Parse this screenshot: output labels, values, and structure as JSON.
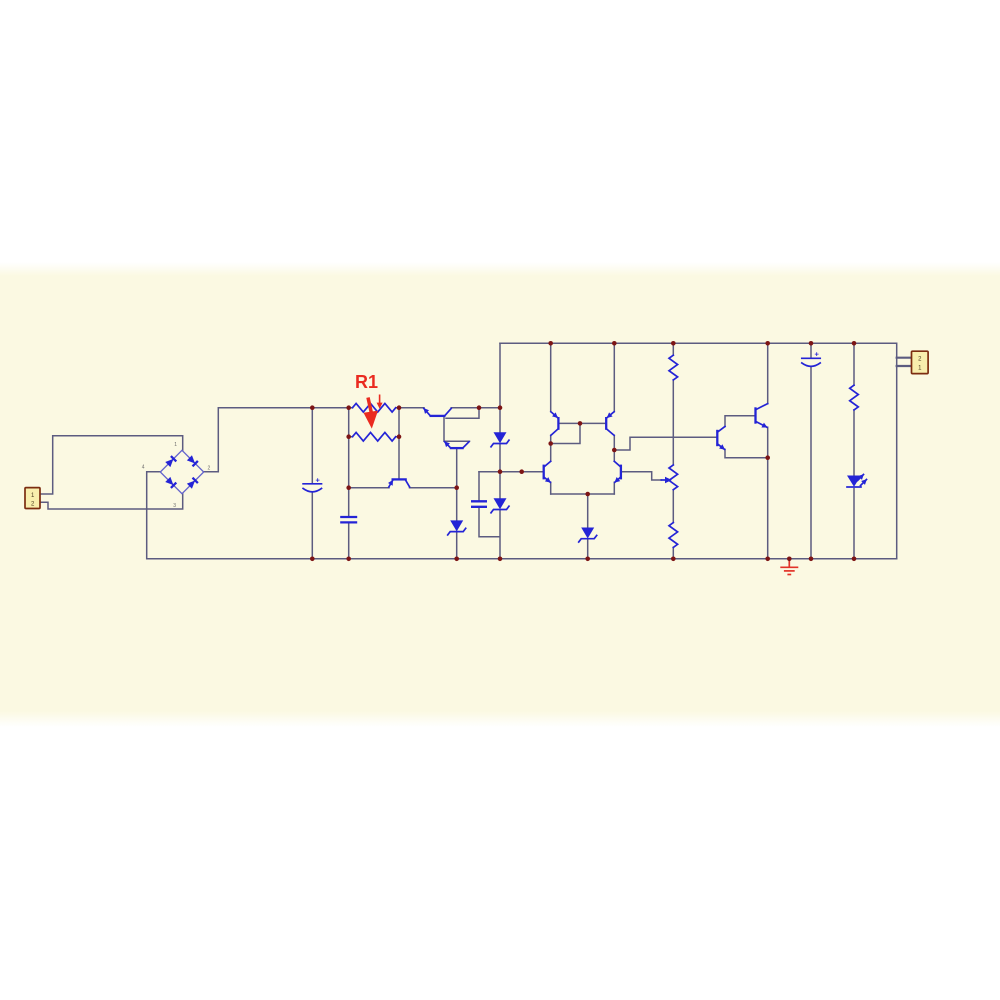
{
  "colors": {
    "band": "#fbf9e2",
    "wire": "#5c5c80",
    "component": "#2424d6",
    "junction": "#7d1515",
    "accent": "#ea2b20",
    "ground": "#e23328",
    "connector_fill": "#f8eead",
    "connector_border": "#7c2d10",
    "pin_text": "#4a3b20",
    "bridge_outline": "#6363cc"
  },
  "annotation": {
    "r1_label": "R1"
  },
  "connectors": {
    "input": {
      "pins": [
        "1",
        "2"
      ]
    },
    "output": {
      "pins": [
        "2",
        "1"
      ]
    }
  },
  "bridge": {
    "pins": [
      "1",
      "2",
      "3",
      "4"
    ]
  },
  "capacitors": {
    "c1_polarity": "+",
    "c3_polarity": "+"
  }
}
